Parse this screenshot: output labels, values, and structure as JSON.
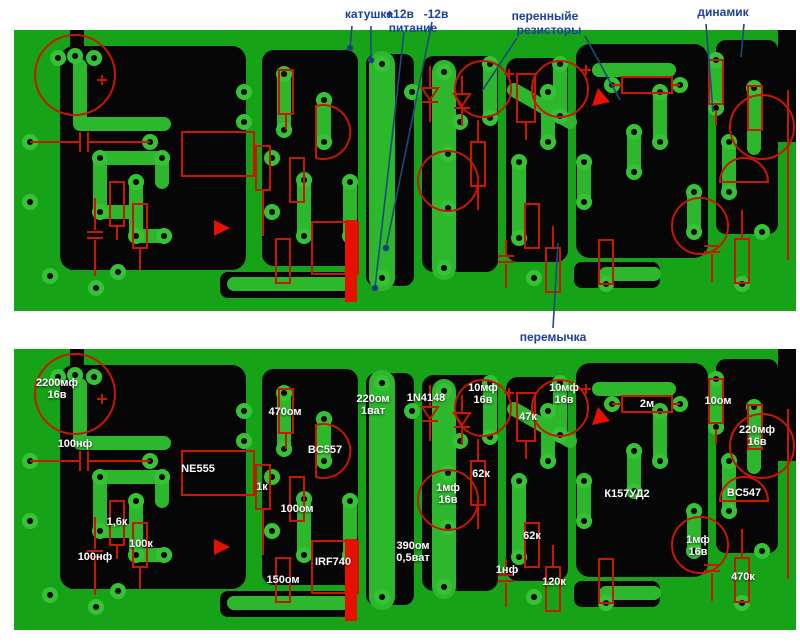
{
  "title": "Печатная плата — разводка с обозначениями компонентов",
  "colors": {
    "board_green": "#17A317",
    "trace_green": "#2DB72D",
    "pad_green": "#35C235",
    "copper_black": "#060606",
    "component_red": "#C81800",
    "bright_red": "#E81000",
    "annotation_blue": "#1D3F9E",
    "value_white": "#FFFFFF"
  },
  "annotations": {
    "coil": "катушка",
    "plus12": "+12в",
    "power": "питание",
    "minus12": "-12в",
    "var_resistors_line1": "перенныйе",
    "var_resistors_line2": "резисторы",
    "speaker": "динамик",
    "jumper": "перемычка"
  },
  "component_labels": [
    {
      "text": "2200мф\n16в"
    },
    {
      "text": "100нф"
    },
    {
      "text": "NE555"
    },
    {
      "text": "1,6к"
    },
    {
      "text": "100к"
    },
    {
      "text": "100нф"
    },
    {
      "text": "470ом"
    },
    {
      "text": "BC557"
    },
    {
      "text": "1к"
    },
    {
      "text": "100ом"
    },
    {
      "text": "220ом\n1ват"
    },
    {
      "text": "1N4148"
    },
    {
      "text": "150ом"
    },
    {
      "text": "IRF740"
    },
    {
      "text": "390ом\n0,5ват"
    },
    {
      "text": "1нф"
    },
    {
      "text": "10мф\n16в"
    },
    {
      "text": "47к"
    },
    {
      "text": "10мф\n16в"
    },
    {
      "text": "2м"
    },
    {
      "text": "62к"
    },
    {
      "text": "1мф\n16в"
    },
    {
      "text": "62к"
    },
    {
      "text": "120к"
    },
    {
      "text": "К157УД2"
    },
    {
      "text": "10ом"
    },
    {
      "text": "220мф\n16в"
    },
    {
      "text": "BC547"
    },
    {
      "text": "1мф\n16в"
    },
    {
      "text": "470к"
    }
  ]
}
